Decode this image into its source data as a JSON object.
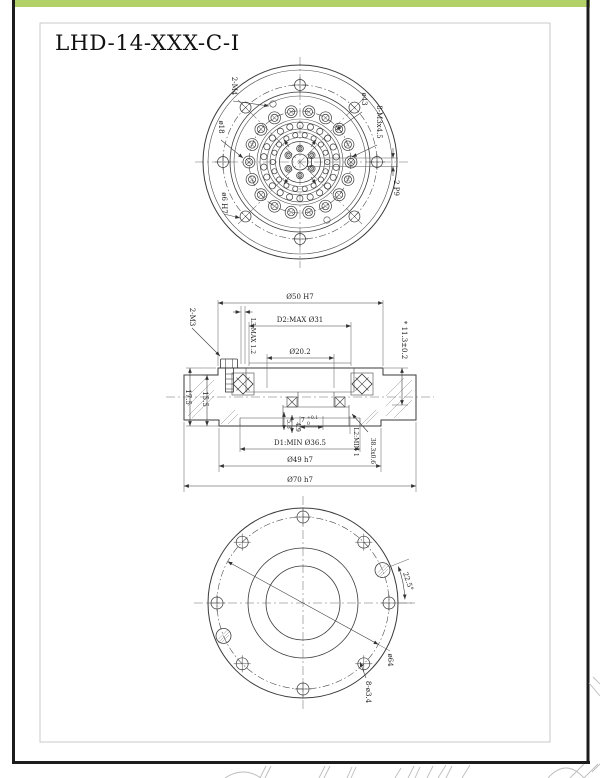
{
  "accent_color": "#b2d169",
  "title": "LHD-14-XXX-C-I",
  "top_view": {
    "labels": {
      "tapped": "2-M4",
      "bolt_circle": "ø43",
      "screws": "8-M3x4.5",
      "bore": "ø18",
      "dowel": "ø6 H7",
      "keyway": "2 P9"
    }
  },
  "section_view": {
    "labels": {
      "d50": "Ø50 H7",
      "d2max": "D2:MAX Ø31",
      "d20": "Ø20.2",
      "l3max": "L3:MAX 1.2",
      "screws": "2-M3",
      "depth": "* 11.3±0.2",
      "h15": "15.5",
      "h17": "17.5",
      "w58": "5.8",
      "w49": "4.9",
      "w7": "7",
      "w7u": "+0.1",
      "w7l": "0",
      "l2min": "L2:MIN 1",
      "groove": "38.3x0.6",
      "d1min": "D1:MIN Ø36.5",
      "d49": "Ø49 h7",
      "d70": "Ø70 h7"
    }
  },
  "bottom_view": {
    "labels": {
      "angle": "22.5°",
      "bolt_circle": "ø64",
      "holes": "8-ø3.4"
    }
  }
}
